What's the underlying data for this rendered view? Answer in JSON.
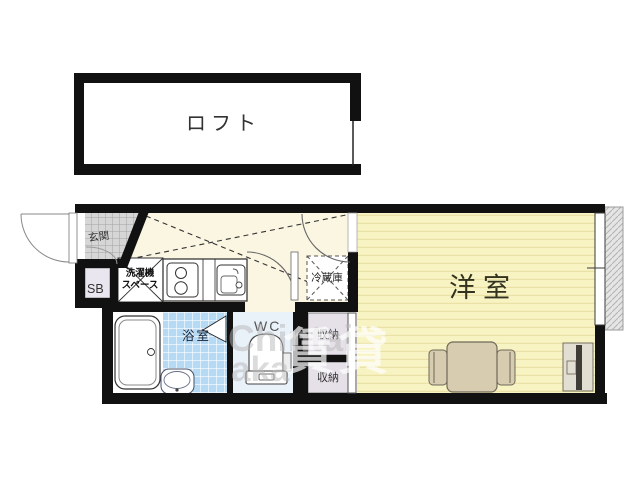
{
  "floorplan": {
    "loft": {
      "label": "ロフト"
    },
    "entrance": {
      "label": "玄関"
    },
    "shoe_box": {
      "label": "SB"
    },
    "laundry": {
      "label_line1": "洗濯機",
      "label_line2": "スペース"
    },
    "refrigerator": {
      "label": "冷蔵庫"
    },
    "bathroom": {
      "label": "浴室"
    },
    "toilet": {
      "label": "WC"
    },
    "storage_upper": {
      "label": "収納"
    },
    "storage_lower": {
      "label": "収納"
    },
    "western_room": {
      "label": "洋室"
    }
  },
  "watermark": {
    "text_top": "Chintai",
    "text_bottom": "aka",
    "kanji": "賃貸"
  },
  "colors": {
    "wall": "#111111",
    "hall_floor": "#faf6e2",
    "room_floor": "#f8f3c3",
    "room_stripe": "#e9e1a6",
    "entrance_tile": "#d6d6d6",
    "bath_tile": "#b7daf4",
    "wc_floor": "#e9f1f9",
    "storage_fill": "#e6e1e9",
    "shoebox_fill": "#eae6ef",
    "balcony_fill": "#e5e5e5",
    "furniture_fill": "#d7cbb0",
    "tv_screen": "#3f3d35",
    "white_fixture": "#ffffff"
  }
}
